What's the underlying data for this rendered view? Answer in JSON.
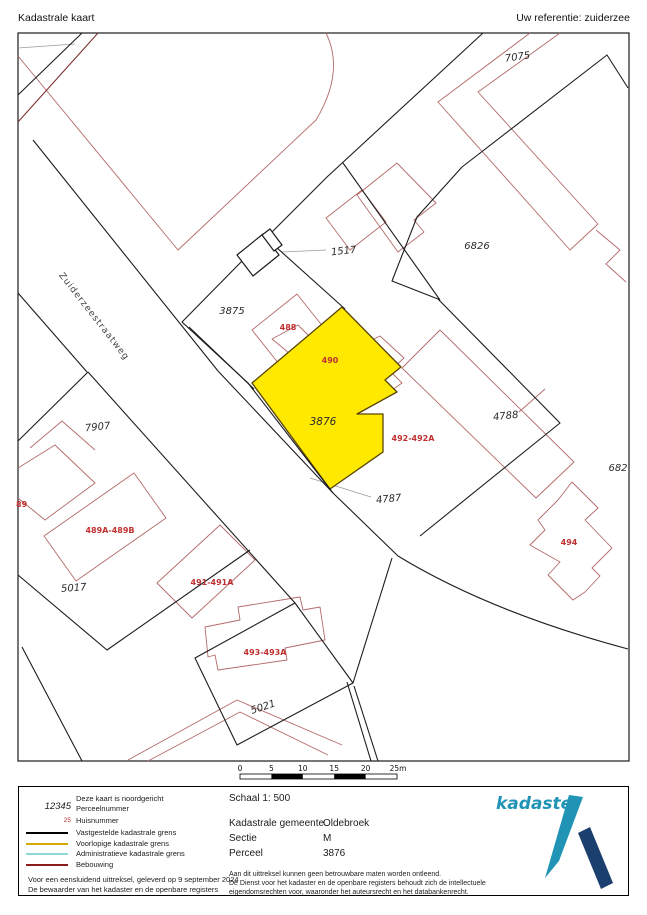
{
  "header": {
    "title": "Kadastrale kaart",
    "reference": "Uw referentie: zuiderzee"
  },
  "map": {
    "road_label": "Zuiderzeestraatweg",
    "highlighted_parcel": "3876",
    "parcel_numbers": {
      "p7075": "7075",
      "p1517": "1517",
      "p6826": "6826",
      "p3875": "3875",
      "p3876": "3876",
      "p4788": "4788",
      "p682": "682",
      "p4787": "4787",
      "p7907": "7907",
      "p5017": "5017",
      "p5021": "5021"
    },
    "house_numbers": {
      "h488": "488",
      "h490": "490",
      "h492": "492-492A",
      "h494": "494",
      "h89": "89",
      "h489": "489A-489B",
      "h491": "491-491A",
      "h493": "493-493A"
    }
  },
  "scalebar": {
    "ticks": {
      "t0": "0",
      "t5": "5",
      "t10": "10",
      "t15": "15",
      "t20": "20",
      "t25": "25m"
    }
  },
  "legend": {
    "north_note": "Deze kaart is noordgericht",
    "perceel_sample": "12345",
    "perceel_label": "Perceelnummer",
    "huis_sample": "25",
    "huis_label": "Huisnummer",
    "line1": "Vastgestelde kadastrale grens",
    "line2": "Voorlopige kadastrale grens",
    "line3": "Administratieve kadastrale grens",
    "line4": "Bebouwing",
    "issued1": "Voor een eensluidend uittreksel, geleverd op 9 september 2024",
    "issued2": "De bewaarder van het kadaster en de openbare registers"
  },
  "info": {
    "schaal": "Schaal 1: 500",
    "gemeente_label": "Kadastrale gemeente",
    "gemeente": "Oldebroek",
    "sectie_label": "Sectie",
    "sectie": "M",
    "perceel_label": "Perceel",
    "perceel": "3876",
    "disclaimer1": "Aan dit uittreksel kunnen geen betrouwbare maten worden ontleend.",
    "disclaimer2": "De Dienst voor het kadaster en de openbare registers behoudt zich de intellectuele",
    "disclaimer3": "eigendomsrechten voor, waaronder het auteursrecht en het databankenrecht."
  },
  "logo": {
    "text": "kadaster"
  },
  "colors": {
    "accent": "#ffe900",
    "building": "#b46a6a",
    "red_label": "#c03030",
    "boundary": "#1c1c1c",
    "provisional": "#d4aa00",
    "administrative": "#8fd8d8",
    "bebouwing": "#8b1f1f",
    "logo_teal": "#2193b5",
    "logo_navy": "#1b3f6e"
  }
}
